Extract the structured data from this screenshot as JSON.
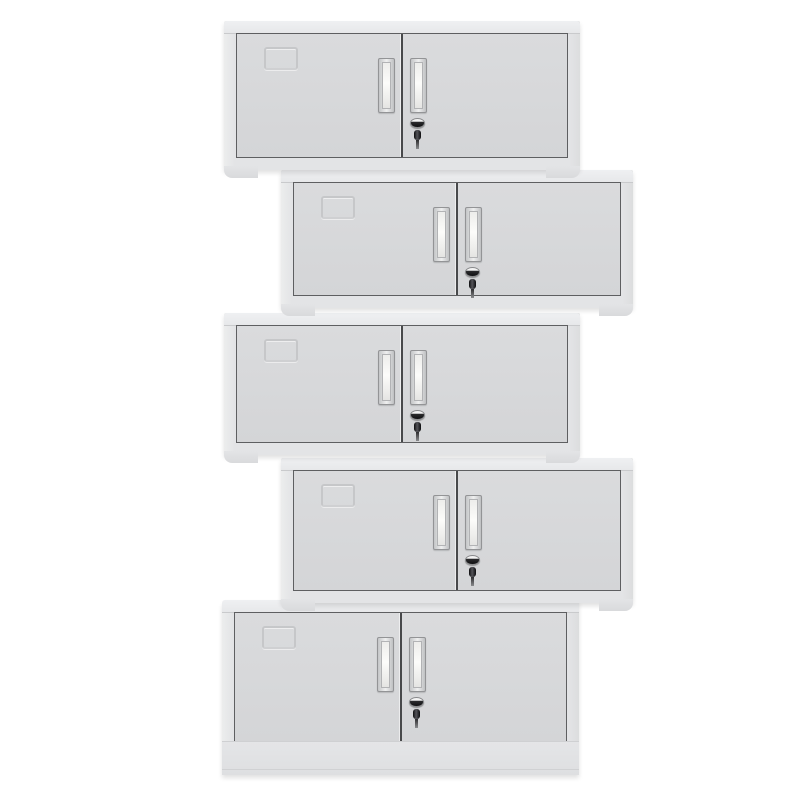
{
  "scene": {
    "subject": "Five two-door light-grey steel cabinets stacked in an alternating zigzag on a white background",
    "background_color": "#ffffff",
    "units_count": 5
  },
  "palette": {
    "body_frame": "#e3e4e6",
    "top_cap": "#eceef0",
    "door_face": "#d6d7d9",
    "door_outline": "#5e5f61",
    "door_divider": "#48494b",
    "label_emboss": "#c5c6c8",
    "handle_chrome": "#eff0f0",
    "handle_border": "#939496",
    "lock_dark": "#101012",
    "lock_chrome": "#f3f3f3"
  },
  "cabinets": [
    {
      "name": "cabinet-1",
      "stack_position": "row-1-left",
      "variant": "wall",
      "left": 224,
      "top": 21,
      "width": 356,
      "height": 149,
      "z": 5
    },
    {
      "name": "cabinet-2",
      "stack_position": "row-2-right",
      "variant": "wall",
      "left": 281,
      "top": 170,
      "width": 352,
      "height": 138,
      "z": 4
    },
    {
      "name": "cabinet-3",
      "stack_position": "row-3-left",
      "variant": "wall",
      "left": 224,
      "top": 313,
      "width": 356,
      "height": 142,
      "z": 3
    },
    {
      "name": "cabinet-4",
      "stack_position": "row-4-right",
      "variant": "wall",
      "left": 281,
      "top": 458,
      "width": 352,
      "height": 145,
      "z": 2
    },
    {
      "name": "cabinet-5",
      "stack_position": "row-5-left",
      "variant": "base",
      "left": 222,
      "top": 600,
      "width": 357,
      "height": 175,
      "z": 1
    }
  ]
}
